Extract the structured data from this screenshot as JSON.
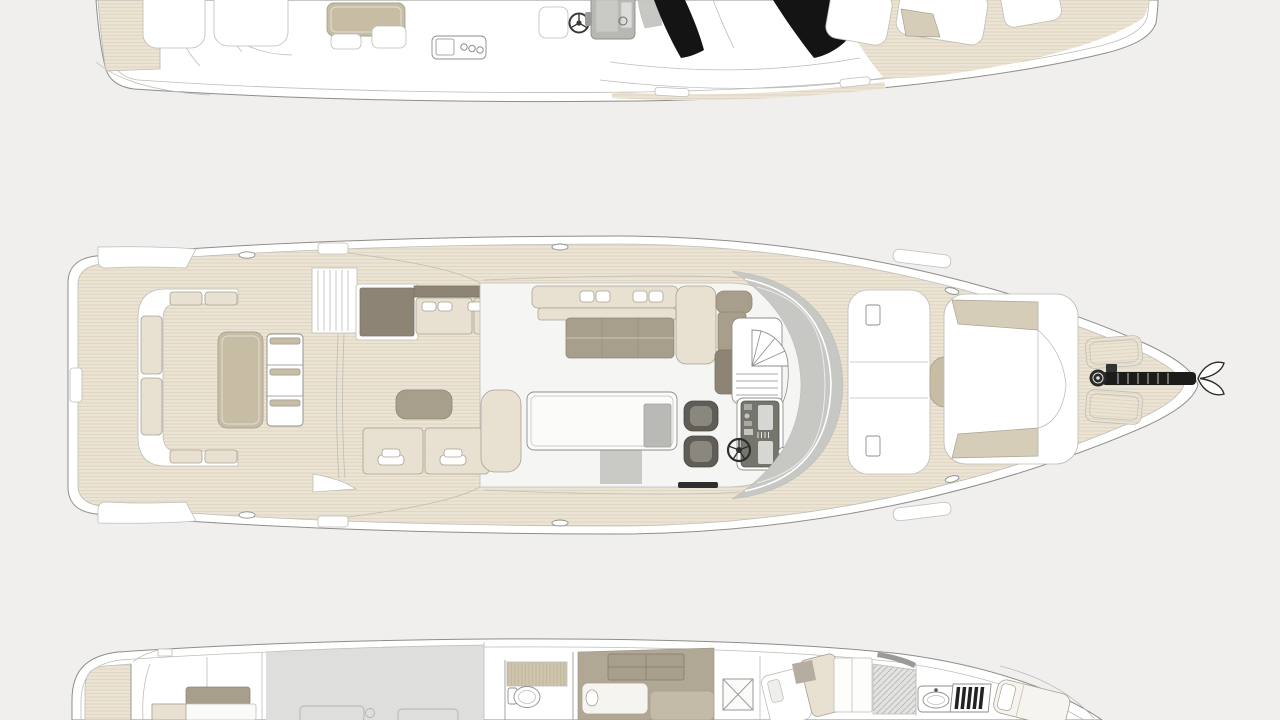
{
  "page": {
    "type": "yacht-general-arrangement-plan",
    "background": "#f0efed"
  },
  "palette": {
    "background": "#f0efed",
    "line": "#8d8d89",
    "line_light": "#bdbdb8",
    "hull_white": "#ffffff",
    "floor_white": "#f5f5f3",
    "teak_deck": "#ebe3d3",
    "teak_plank_line": "#dcd1ba",
    "cushion_cream": "#e8e1d2",
    "cushion_stroke": "#a9a193",
    "table_tan": "#c7bda5",
    "sunpad_tan": "#d6cdb8",
    "furniture_taupe": "#a89e8c",
    "furniture_dark_taupe": "#8d8475",
    "glass_gray": "#c7c7c4",
    "glass_black": "#141414",
    "engine_room_gray": "#dededc",
    "console_gray": "#b7b7b4",
    "seat_dark": "#5f5d56",
    "seat_dark_inner": "#8a887e",
    "rug_gray": "#c9c9c6",
    "carpet_taupe": "#b1a795",
    "shower_teak": "#cfc5ae",
    "hatch_gray": "#e2e2e0"
  },
  "decks": [
    {
      "id": "flybridge",
      "name": "flybridge-deck-plan",
      "crop": "top-edge",
      "features": [
        "side-sunpad",
        "lounge-seats",
        "dinette-table",
        "wet-bar",
        "helm-seat",
        "steering-wheel",
        "helm-console",
        "windshield-glass",
        "bow-sunpads"
      ]
    },
    {
      "id": "main",
      "name": "main-deck-plan",
      "crop": "none",
      "features": [
        "transom-platforms",
        "cockpit-c-sofa",
        "cockpit-table",
        "folding-chair-stack",
        "flybridge-stairs",
        "outdoor-galley",
        "port-bench",
        "salon-sofa",
        "coffee-table",
        "stair-bench",
        "spiral-staircase",
        "helm-seats",
        "helm-console",
        "steering-wheel",
        "dinette-table",
        "dinette-bench",
        "windshield-glass",
        "foredeck-sunpads",
        "bow-lockers",
        "anchor-windlass",
        "anchor"
      ]
    },
    {
      "id": "lower",
      "name": "lower-deck-plan",
      "crop": "bottom-edge",
      "features": [
        "aft-cabin-bed",
        "engine-room",
        "shower",
        "toilet",
        "twin-cabin-beds",
        "wardrobe",
        "x-hatch",
        "vip-cabin-bed",
        "vanity-sink",
        "companionway-steps",
        "bow-cabin-bed"
      ]
    }
  ],
  "icons": {
    "steering-wheel": "circle-with-spokes",
    "anchor": "double-fluke",
    "windlass-gear": "spoked-disc",
    "spiral-staircase": "quarter-fan-with-treads",
    "toilet": "oval-bowl",
    "sink": "oval-basin",
    "cleat": "small-oval",
    "companionway-steps": "striped-ladder",
    "x-hatch": "crossed-square",
    "engine": "faint-block"
  }
}
